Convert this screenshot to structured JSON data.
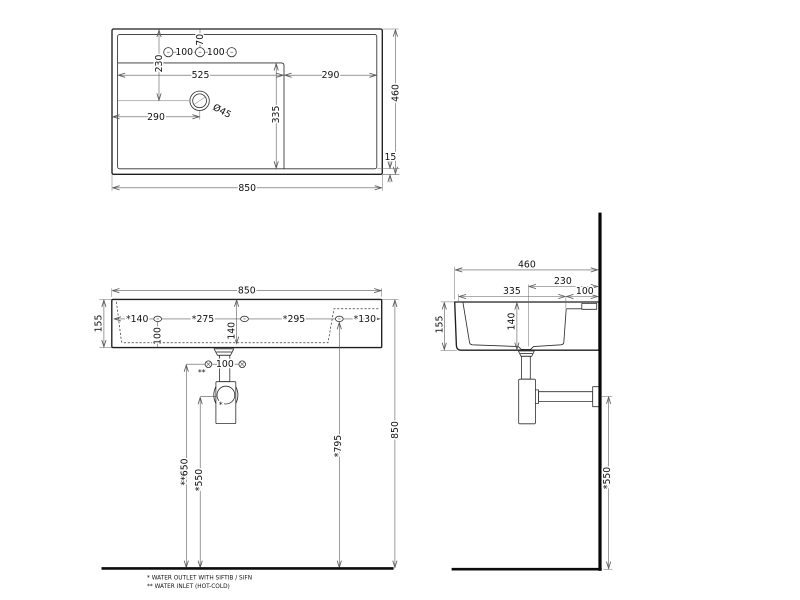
{
  "document": {
    "type": "technical drawing",
    "subject": "Wall-hung washbasin installation dimensions (top, front and side views)",
    "units": "mm",
    "line_color": "#1f1f1f",
    "background_color": "#ffffff"
  },
  "top_view": {
    "dims": {
      "width": "850",
      "depth": "460",
      "rim": "15",
      "tap_offset": "70",
      "tap_spacing_left": "100",
      "tap_spacing_right": "100",
      "drain_from_rear": "230",
      "bowl_width": "525",
      "right_deck": "290",
      "drain_from_left": "290",
      "drain_diameter": "Ø45",
      "bowl_length": "335"
    }
  },
  "front_view": {
    "dims": {
      "width": "850",
      "height": "155",
      "hole_left": "*140",
      "hole_span_1": "*275",
      "hole_span_2": "*295",
      "hole_right": "*130",
      "hole_to_bottom": "100",
      "inner_depth": "140",
      "inlet_spacing": "100",
      "inlet_ref": "**",
      "outlet_ref": "*",
      "inlet_height": "**650",
      "siphon_height": "*550",
      "holes_height": "*795",
      "rim_height": "850"
    }
  },
  "side_view": {
    "dims": {
      "depth": "460",
      "drain_from_wall": "230",
      "bowl_depth": "335",
      "rear_deck": "100",
      "height": "155",
      "inner_depth": "140",
      "outlet_height": "*550"
    }
  },
  "notes": [
    "*  WATER OUTLET WITH SIFTIB / SIFN",
    "** WATER INLET  (HOT-COLD)"
  ]
}
